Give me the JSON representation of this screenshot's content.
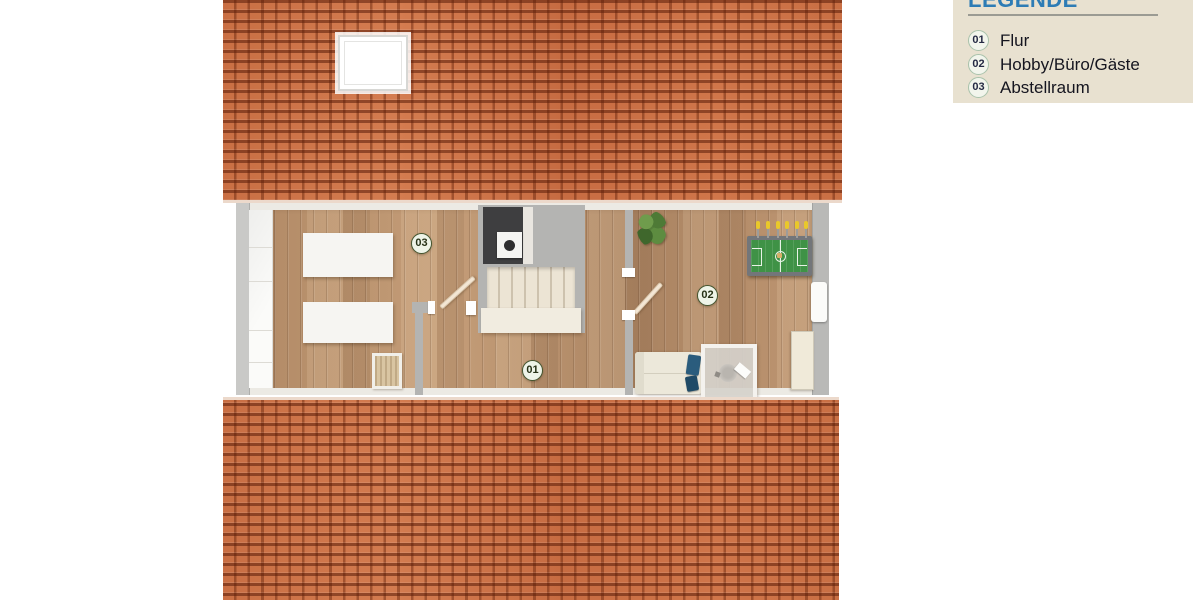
{
  "legend": {
    "title": "LEGENDE",
    "items": [
      {
        "badge": "01",
        "label": "Flur"
      },
      {
        "badge": "02",
        "label": "Hobby/Büro/Gäste"
      },
      {
        "badge": "03",
        "label": "Abstellraum"
      }
    ]
  },
  "plan": {
    "rooms": [
      {
        "number": "01",
        "name": "Flur"
      },
      {
        "number": "02",
        "name": "Hobby/Büro/Gäste"
      },
      {
        "number": "03",
        "name": "Abstellraum"
      }
    ]
  },
  "colors": {
    "roof_tile": "#cb7146",
    "roof_gap": "#7d2c10",
    "floor_wood": "#b68f6c",
    "wall_gray": "#b9b9b7",
    "legend_bg": "#e8e1d0",
    "legend_title_blue": "#2d7cb5",
    "badge_border_green": "#a9c2ab",
    "room_badge_green": "#44552f",
    "foosball_green": "#3f9246",
    "pillow_blue": "#2a5c7d"
  }
}
